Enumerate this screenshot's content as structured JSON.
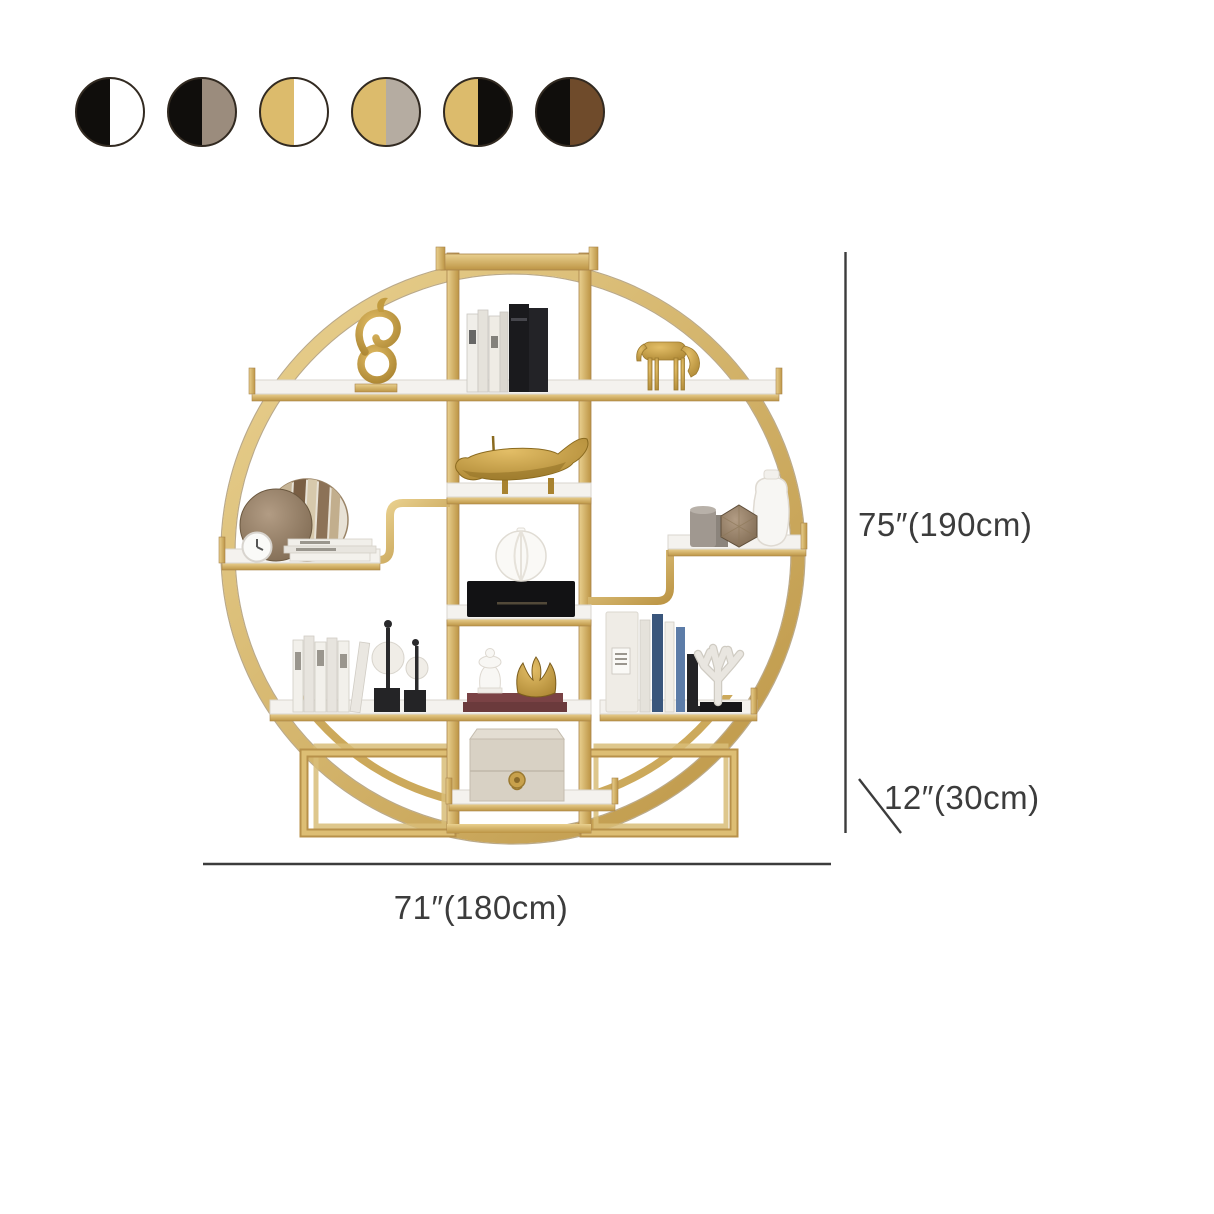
{
  "swatches": [
    {
      "name": "black-white",
      "left": "#100e0c",
      "right": "#ffffff"
    },
    {
      "name": "black-taupe",
      "left": "#100e0c",
      "right": "#9b8c7d"
    },
    {
      "name": "gold-white",
      "left": "#dcbb6c",
      "right": "#ffffff"
    },
    {
      "name": "gold-gray",
      "left": "#dcbb6c",
      "right": "#b5aca1"
    },
    {
      "name": "gold-black",
      "left": "#dcbb6c",
      "right": "#100e0c"
    },
    {
      "name": "black-brown",
      "left": "#100e0c",
      "right": "#6f4b2b"
    }
  ],
  "dimensions": {
    "height": "75″(190cm)",
    "depth": "12″(30cm)",
    "width": "71″(180cm)"
  },
  "colors": {
    "frame_gold": "#d2ab58",
    "frame_gold_dark": "#b08b42",
    "frame_gold_light": "#e9d08f",
    "marble_white": "#f4f2ee",
    "annotation": "#3c3c3c",
    "swatch_border": "#322a21",
    "background": "#ffffff"
  }
}
